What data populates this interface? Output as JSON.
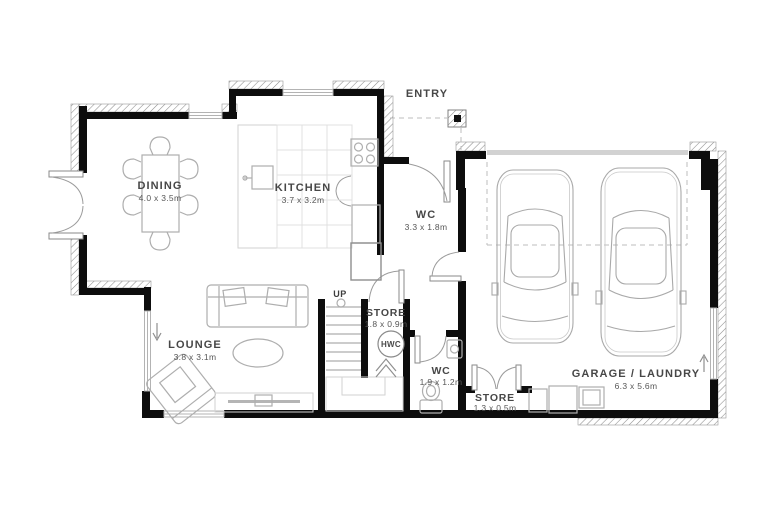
{
  "labels": {
    "entry": "ENTRY",
    "up": "UP",
    "hwc": "HWC"
  },
  "rooms": {
    "dining": {
      "name": "DINING",
      "dims": "4.0 x 3.5m"
    },
    "kitchen": {
      "name": "KITCHEN",
      "dims": "3.7 x 3.2m"
    },
    "wc_hall": {
      "name": "WC",
      "dims": "3.3 x 1.8m"
    },
    "lounge": {
      "name": "LOUNGE",
      "dims": "3.8 x 3.1m"
    },
    "store": {
      "name": "STORE",
      "dims": "1.8 x 0.9m"
    },
    "wc_small": {
      "name": "WC",
      "dims": "1.9 x 1.2m"
    },
    "store_small": {
      "name": "STORE",
      "dims": "1.3 x 0.5m"
    },
    "garage": {
      "name": "GARAGE / LAUNDRY",
      "dims": "6.3 x 5.6m"
    }
  },
  "colors": {
    "wall": "#0d0d0d",
    "furniture_line": "#aeaeae",
    "label_text": "#474747",
    "hatch": "#8d8d8d",
    "background": "#ffffff"
  }
}
